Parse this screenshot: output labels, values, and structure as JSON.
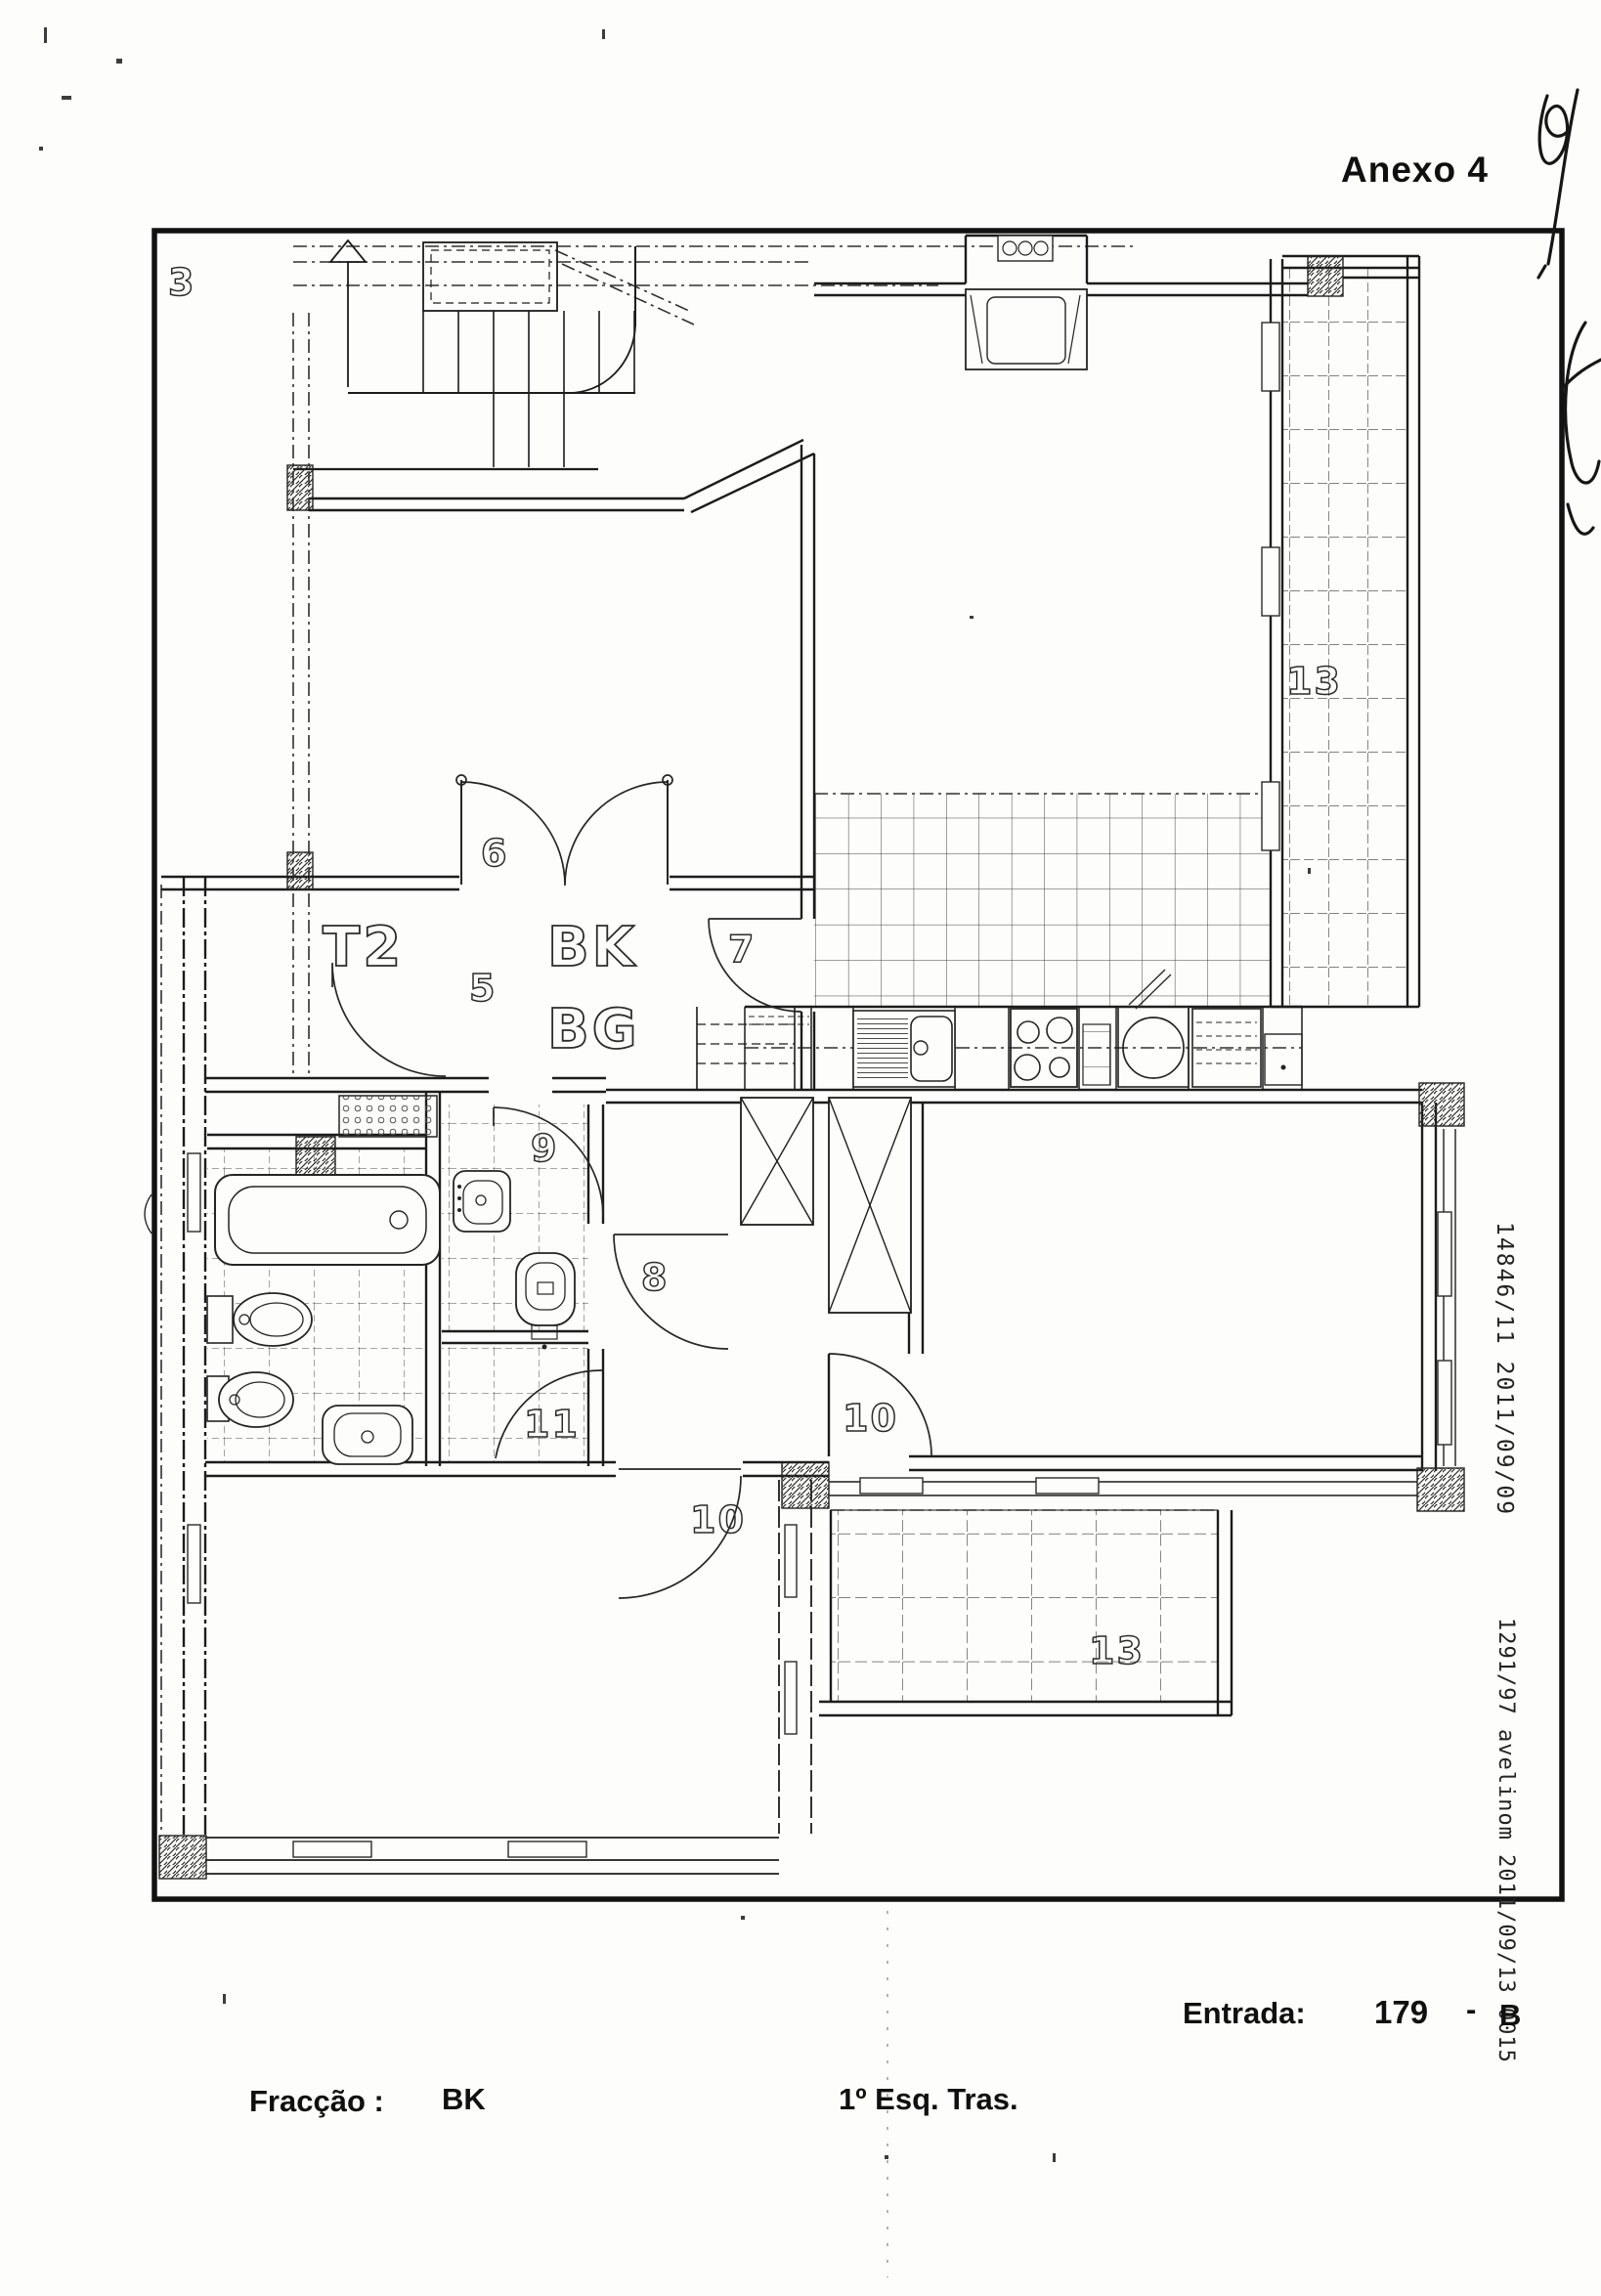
{
  "header": {
    "annex_label": "Anexo 4"
  },
  "plan": {
    "sheet_number": "3",
    "labels": {
      "t2": "T2",
      "bk": "BK",
      "bg": "BG",
      "door6": "6",
      "room5": "5",
      "door7": "7",
      "corridor8": "8",
      "bath9": "9",
      "door10_bedroom": "10",
      "door10_living": "10",
      "hall11": "11",
      "balcony13_right": "13",
      "balcony13_bottom": "13"
    }
  },
  "registry": {
    "line1": "14846/11 2011/09/09",
    "line2": "1291/97 avelinom 2011/09/13 0015"
  },
  "footer": {
    "entrada_label": "Entrada:",
    "entrada_number": "179",
    "entrada_separator": "-",
    "entrada_letter": "B",
    "fraccao_label": "Fracção :",
    "fraccao_value": "BK",
    "location_value": "1º Esq. Tras."
  },
  "colors": {
    "ink": "#1c1c1c",
    "paper": "#fdfdfb"
  }
}
